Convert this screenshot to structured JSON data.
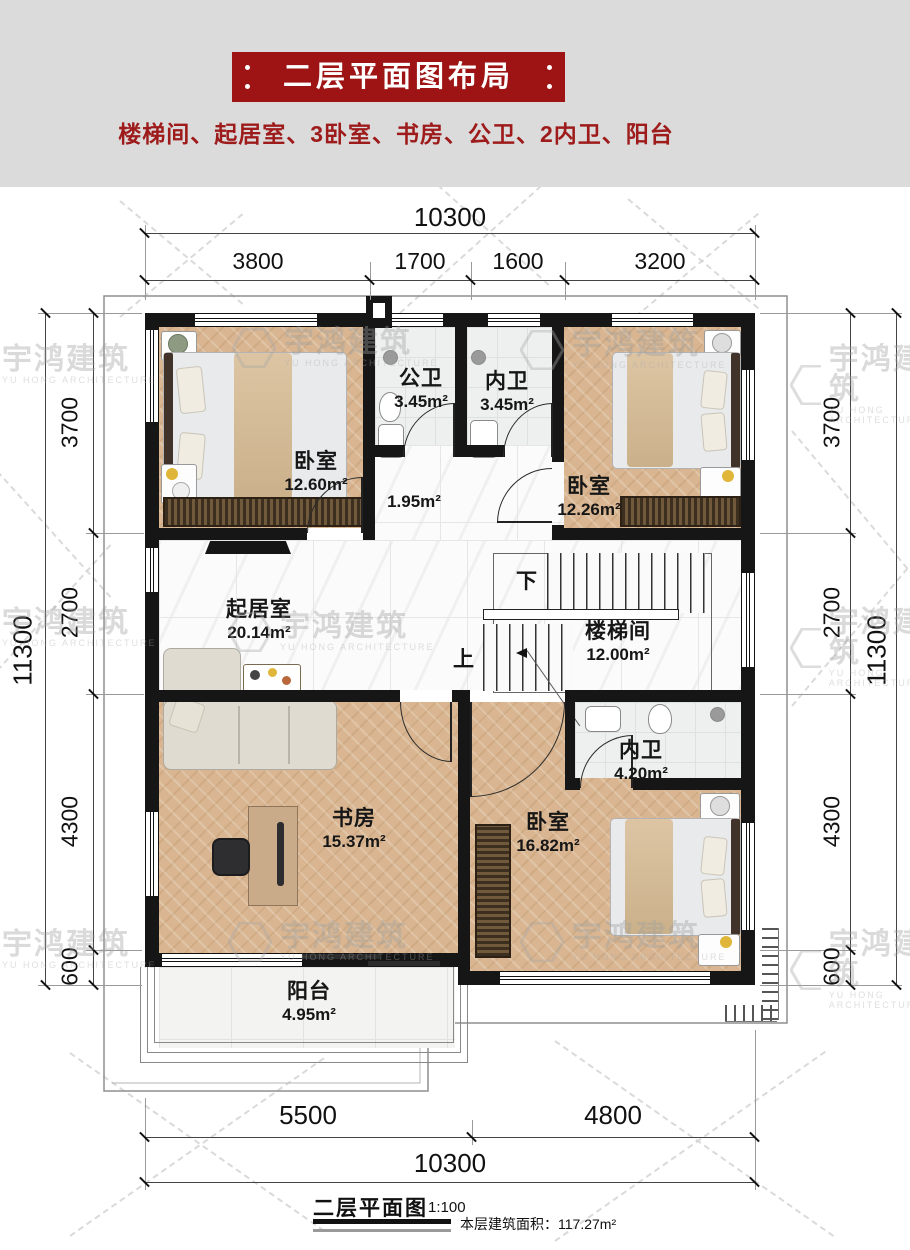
{
  "header": {
    "title": "二层平面图布局",
    "subtitle": "楼梯间、起居室、3卧室、书房、公卫、2内卫、阳台",
    "banner_color": "#9e1414",
    "text_color": "#9e1b1b"
  },
  "watermark": {
    "cn": "宇鸿建筑",
    "en": "YU HONG ARCHITECTURE"
  },
  "dims": {
    "top_total": "10300",
    "t1": "3800",
    "t2": "1700",
    "t3": "1600",
    "t4": "3200",
    "side_total": "11300",
    "l1": "3700",
    "l2": "2700",
    "l3": "4300",
    "l4": "600",
    "b1": "5500",
    "b2": "4800",
    "bottom_total": "10300"
  },
  "rooms": {
    "bedroom1": {
      "name": "卧室",
      "area": "12.60m²"
    },
    "bath_public": {
      "name": "公卫",
      "area": "3.45m²"
    },
    "bath_inner1": {
      "name": "内卫",
      "area": "3.45m²"
    },
    "bedroom2": {
      "name": "卧室",
      "area": "12.26m²"
    },
    "hallway": {
      "area": "1.95m²"
    },
    "living": {
      "name": "起居室",
      "area": "20.14m²"
    },
    "stairwell": {
      "name": "楼梯间",
      "area": "12.00m²"
    },
    "bath_inner2": {
      "name": "内卫",
      "area": "4.20m²"
    },
    "study": {
      "name": "书房",
      "area": "15.37m²"
    },
    "bedroom3": {
      "name": "卧室",
      "area": "16.82m²"
    },
    "balcony": {
      "name": "阳台",
      "area": "4.95m²"
    }
  },
  "stairs": {
    "down": "下",
    "up": "上"
  },
  "footer": {
    "title": "二层平面图",
    "scale": "1:100",
    "area_text": "本层建筑面积：117.27m²"
  }
}
